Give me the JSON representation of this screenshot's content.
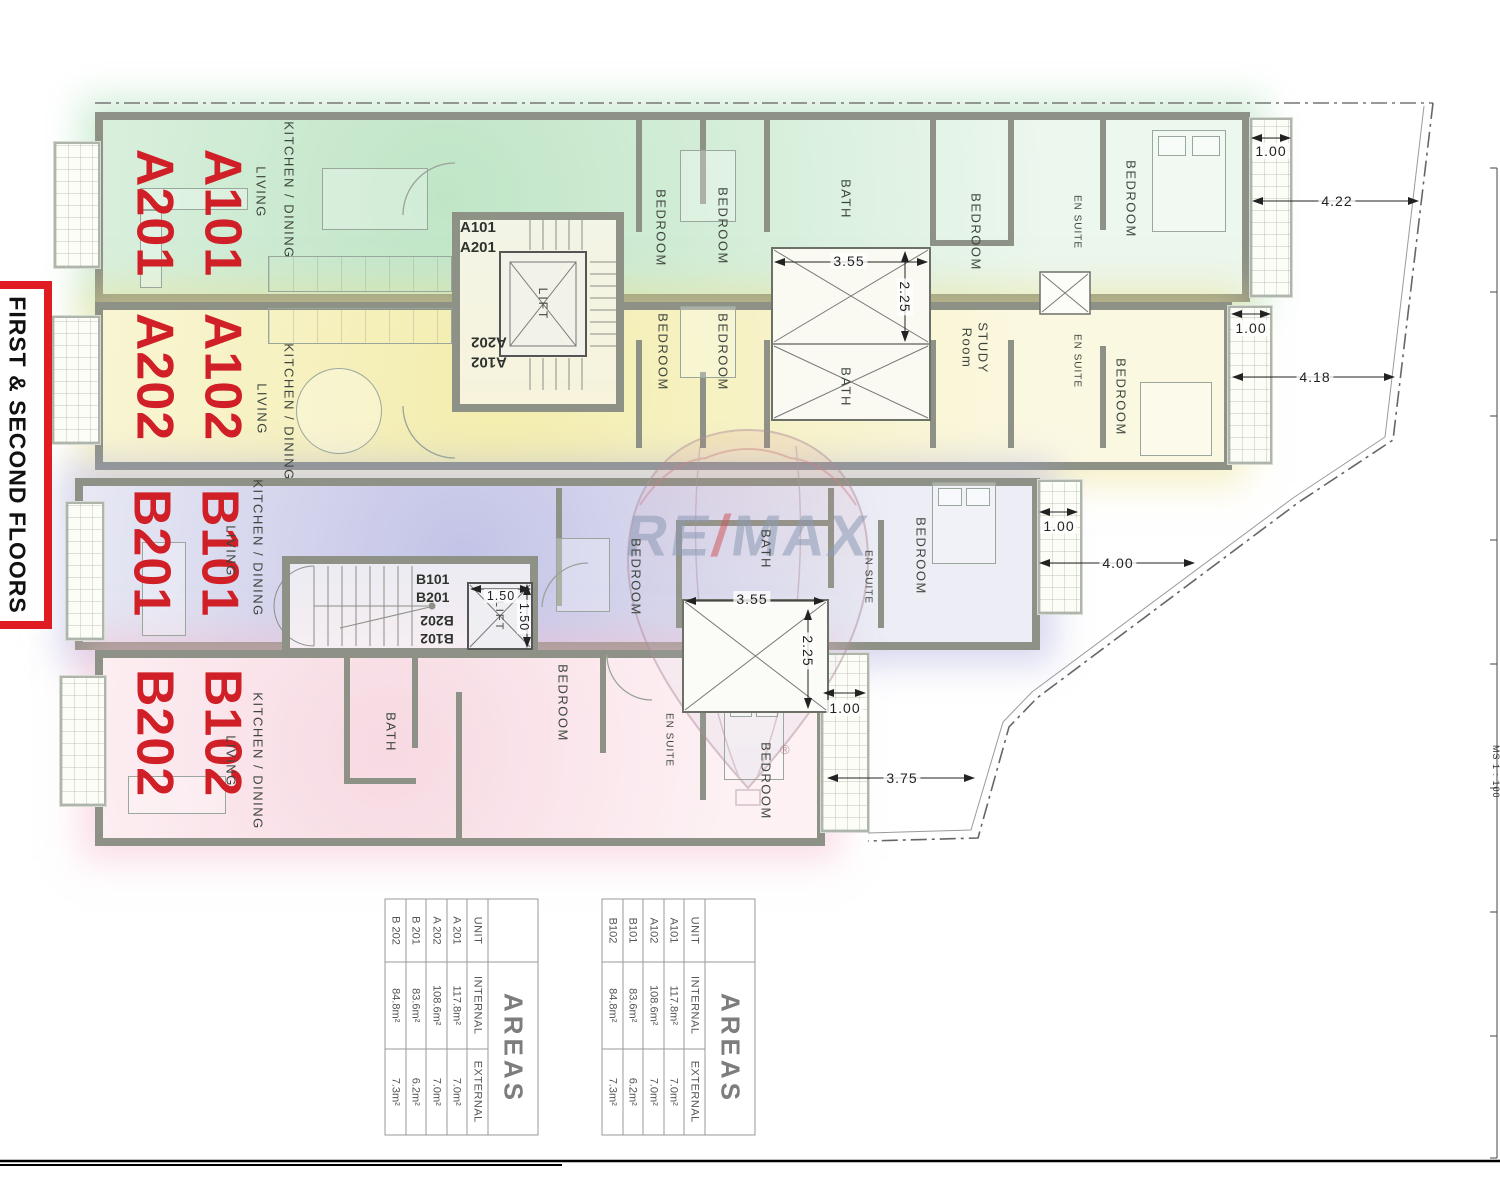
{
  "colors": {
    "zone_green": "#bfe5c6",
    "zone_yellow": "#f3edac",
    "zone_blue": "#c3c3e7",
    "zone_pink": "#f7d9e2",
    "unit_label_red": "#d01f26",
    "wall_gray": "#8e9286",
    "floors_box_red": "#e11b22",
    "remax_blue": "#8d9bb5",
    "remax_red": "#cf5a5f"
  },
  "title_block": {
    "floors_label": "FIRST & SECOND FLOORS",
    "scale_note": "MS 1 : 100"
  },
  "watermark": {
    "re": "RE",
    "slash": "/",
    "max": "MAX",
    "registered": "®"
  },
  "plan": {
    "unit_labels": {
      "green": [
        "A101",
        "A201"
      ],
      "yellow": [
        "A102",
        "A202"
      ],
      "blue": [
        "B101",
        "B201"
      ],
      "pink": [
        "B102",
        "B202"
      ]
    },
    "cores": {
      "a": {
        "upper1": "A101",
        "upper2": "A201",
        "lower1": "A102",
        "lower2": "A202",
        "lift": "LIFT"
      },
      "b": {
        "upper1": "B101",
        "upper2": "B201",
        "lower1": "B102",
        "lower2": "B202",
        "lift": "LIFT"
      }
    },
    "rooms": {
      "green": {
        "kitchen": "KITCHEN / DINING",
        "living": "LIVING",
        "bed1": "BEDROOM",
        "bed2": "BEDROOM",
        "bath": "BATH",
        "bed3": "BEDROOM",
        "ensuite": "EN SUITE",
        "bed4": "BEDROOM"
      },
      "yellow": {
        "kitchen": "KITCHEN / DINING",
        "living": "LIVING",
        "bed1": "BEDROOM",
        "bed2": "BEDROOM",
        "bath": "BATH",
        "study1": "STUDY",
        "study2": "Room",
        "ensuite": "EN SUITE",
        "bed3": "BEDROOM"
      },
      "blue": {
        "kitchen": "KITCHEN / DINING",
        "living": "LIVING",
        "bed1": "BEDROOM",
        "bath": "BATH",
        "ensuite": "EN SUITE",
        "bed2": "BEDROOM"
      },
      "pink": {
        "kitchen": "KITCHEN / DINING",
        "living": "LIVING",
        "bath": "BATH",
        "bed1": "BEDROOM",
        "ensuite": "EN SUITE",
        "bed2": "BEDROOM"
      }
    },
    "dimensions": {
      "green_balcony": "1.00",
      "green_terrace": "4.22",
      "yellow_balcony": "1.00",
      "yellow_terrace": "4.18",
      "shaft_a_w": "3.55",
      "shaft_a_h": "2.25",
      "shaft_b_w": "3.55",
      "shaft_b_h": "2.25",
      "blue_balcony": "1.00",
      "blue_terrace": "4.00",
      "pink_balcony": "1.00",
      "pink_terrace": "3.75",
      "lift_b_w": "1.50",
      "lift_b_h": "1.50"
    }
  },
  "tables": {
    "left": {
      "title": "AREAS",
      "headers": [
        "UNIT",
        "INTERNAL",
        "EXTERNAL"
      ],
      "rows": [
        [
          "A 201",
          "117.8m²",
          "7.0m²"
        ],
        [
          "A 202",
          "108.6m²",
          "7.0m²"
        ],
        [
          "B 201",
          "83.6m²",
          "6.2m²"
        ],
        [
          "B 202",
          "84.8m²",
          "7.3m²"
        ]
      ]
    },
    "right": {
      "title": "AREAS",
      "headers": [
        "UNIT",
        "INTERNAL",
        "EXTERNAL"
      ],
      "rows": [
        [
          "A101",
          "117.8m²",
          "7.0m²"
        ],
        [
          "A102",
          "108.6m²",
          "7.0m²"
        ],
        [
          "B101",
          "83.6m²",
          "6.2m²"
        ],
        [
          "B102",
          "84.8m²",
          "7.3m²"
        ]
      ]
    }
  }
}
